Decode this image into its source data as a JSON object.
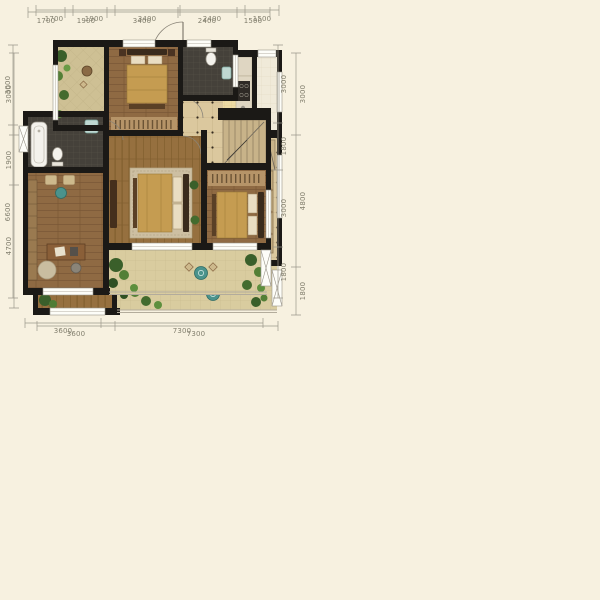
{
  "image": {
    "kind": "duplex-apartment-floor-plan",
    "background": "#f7f1e0"
  },
  "plans": [
    {
      "name": "lower-floor",
      "dims": {
        "top": [
          "1700",
          "1900",
          "3400",
          "2400",
          "1500"
        ],
        "left": [
          "3000",
          "1900",
          "4700"
        ],
        "right": [
          "3000",
          "4800",
          "1800"
        ],
        "bottom": [
          "3600",
          "7300"
        ]
      },
      "room_semantics": [
        "bedroom",
        "closet",
        "entry",
        "kitchen",
        "service-balcony",
        "hallway",
        "bathroom",
        "living-room",
        "dining-area",
        "stairs",
        "master-bedroom",
        "balcony"
      ]
    },
    {
      "name": "upper-floor",
      "dims": {
        "top": [
          "1700",
          "1900",
          "3400",
          "2400",
          "1500"
        ],
        "left": [
          "3000",
          "6600"
        ],
        "right": [
          "3000",
          "1800",
          "3000",
          "1800"
        ],
        "bottom": [
          "3600",
          "7300"
        ]
      },
      "room_semantics": [
        "terrace",
        "bedroom",
        "bathroom",
        "landing",
        "stairs",
        "bathroom-2",
        "study",
        "bedroom-2",
        "bedroom-3",
        "balcony"
      ]
    }
  ],
  "colors": {
    "wall": "#1b1916",
    "wood": "#a1784c",
    "tile": "#dbc89e",
    "kitchen_tile": "#ecdaa4",
    "bath_tile": "#45413a",
    "plant_green": "#4e7c35",
    "accent_teal": "#4b938c",
    "dim_text": "#817e6d"
  }
}
